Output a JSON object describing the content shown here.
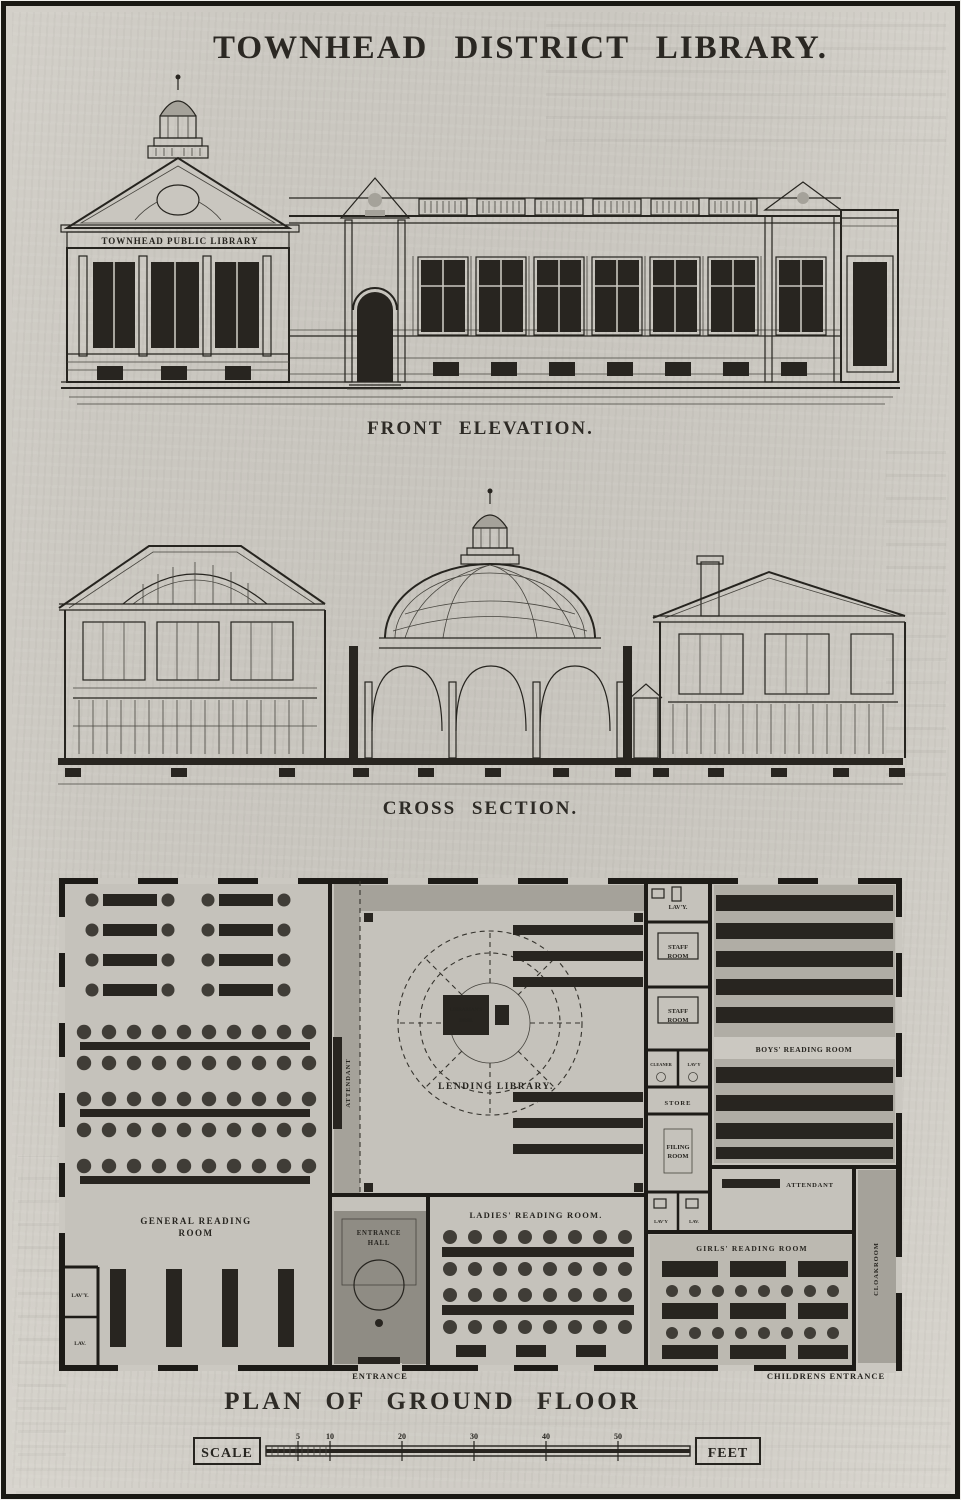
{
  "title": "TOWNHEAD DISTRICT LIBRARY.",
  "elevation": {
    "caption": "FRONT ELEVATION.",
    "frieze": "TOWNHEAD PUBLIC LIBRARY"
  },
  "section": {
    "caption": "CROSS SECTION."
  },
  "plan": {
    "caption": "PLAN OF GROUND FLOOR",
    "entrance_label": "ENTRANCE",
    "childrens_entrance_label": "CHILDRENS ENTRANCE",
    "rooms": {
      "general_reading": {
        "line1": "GENERAL READING",
        "line2": "ROOM"
      },
      "lending": "LENDING LIBRARY.",
      "librarians_desk": {
        "line1": "LIBRARIAN'S",
        "line2": "DESK"
      },
      "attendant_left": "ATTENDANT",
      "attendant_right": "ATTENDANT",
      "lavy_top": "LAV'Y.",
      "staff_room_1": {
        "line1": "STAFF",
        "line2": "ROOM"
      },
      "staff_room_2": {
        "line1": "STAFF",
        "line2": "ROOM"
      },
      "cleaner": "CLEANER",
      "lavy_mid": "LAV'Y",
      "store": "STORE",
      "filing_room": {
        "line1": "FILING",
        "line2": "ROOM"
      },
      "lavy_low1": "LAV'Y",
      "lavy_low2": "LAV.",
      "boys": "BOYS' READING ROOM",
      "ladies": "LADIES' READING ROOM.",
      "girls": "GIRLS' READING ROOM",
      "entrance_hall": {
        "line1": "ENTRANCE",
        "line2": "HALL"
      },
      "cloakroom": "CLOAKROOM",
      "lavy_sw1": "LAV'Y.",
      "lavy_sw2": "LAV."
    }
  },
  "scale_bar": {
    "left_label": "SCALE",
    "right_label": "FEET",
    "ticks": [
      "5",
      "10",
      "20",
      "30",
      "40",
      "50"
    ]
  }
}
